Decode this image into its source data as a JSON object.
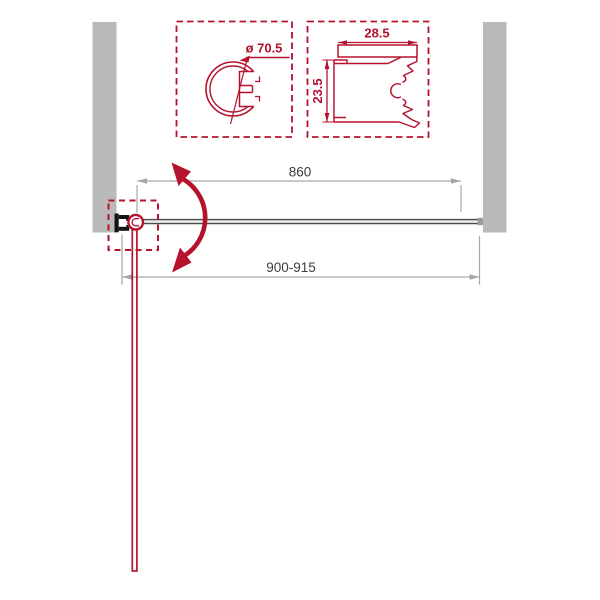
{
  "colors": {
    "accent_red": "#b5122e",
    "wall_gray": "#bababa",
    "dimension_line_gray": "#a6a6a6",
    "dimension_text": "#3d3d3d",
    "glass_line": "#4b4b4b"
  },
  "detail_views": {
    "pivot_profile": {
      "diameter_label": "ø 70.5"
    },
    "wall_profile": {
      "width_label": "28.5",
      "height_label": "23.5"
    }
  },
  "dimensions": {
    "door_width": "860",
    "opening_width": "900-915"
  }
}
